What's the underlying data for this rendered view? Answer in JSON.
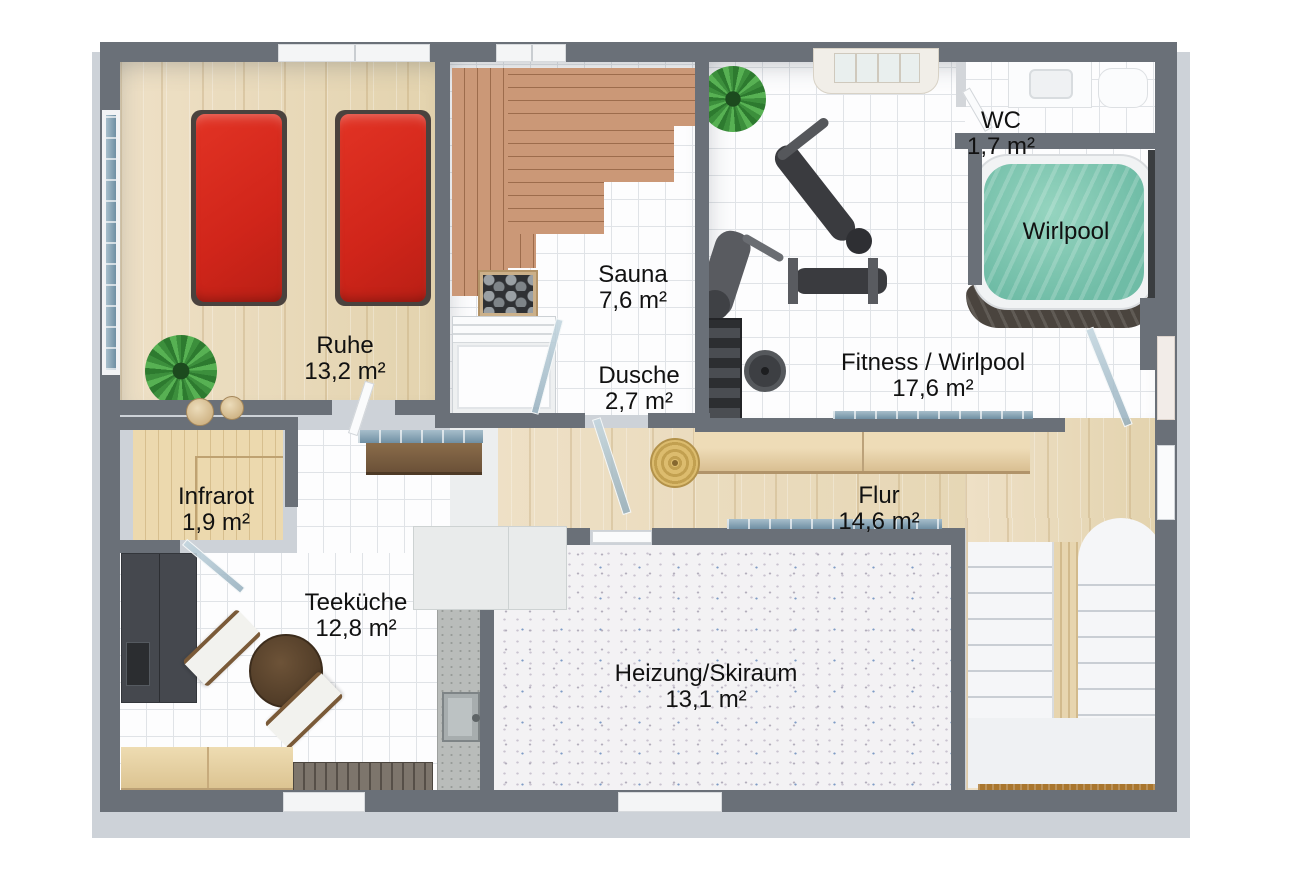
{
  "plan_title": "Untergeschoss Wellness-Grundriss",
  "rooms": [
    {
      "name": "Ruhe",
      "area": "13,2 m²"
    },
    {
      "name": "Sauna",
      "area": "7,6 m²"
    },
    {
      "name": "Dusche",
      "area": "2,7 m²"
    },
    {
      "name": "WC",
      "area": "1,7 m²"
    },
    {
      "name": "Fitness / Wirlpool",
      "area": "17,6 m²"
    },
    {
      "name": "Flur",
      "area": "14,6 m²"
    },
    {
      "name": "Infrarot",
      "area": "1,9 m²"
    },
    {
      "name": "Teeküche",
      "area": "12,8 m²"
    },
    {
      "name": "Heizung/Skiraum",
      "area": "13,1 m²"
    }
  ],
  "fixtures": {
    "wirlpool_label": "Wirlpool"
  },
  "colors": {
    "wall": "#6a7078",
    "plinth": "#cdd2d8",
    "wood_floor": "#e9dbbc",
    "tile_floor": "#fdfdfe",
    "sauna_wood": "#cb9877",
    "infrared_wood": "#ecd9ae",
    "lounger_red": "#d6291c",
    "whirlpool_water": "#7fc7b2",
    "speckle_floor": "#f3f2f4",
    "glass_blue": "#7d9db3",
    "label_text": "#111111"
  }
}
